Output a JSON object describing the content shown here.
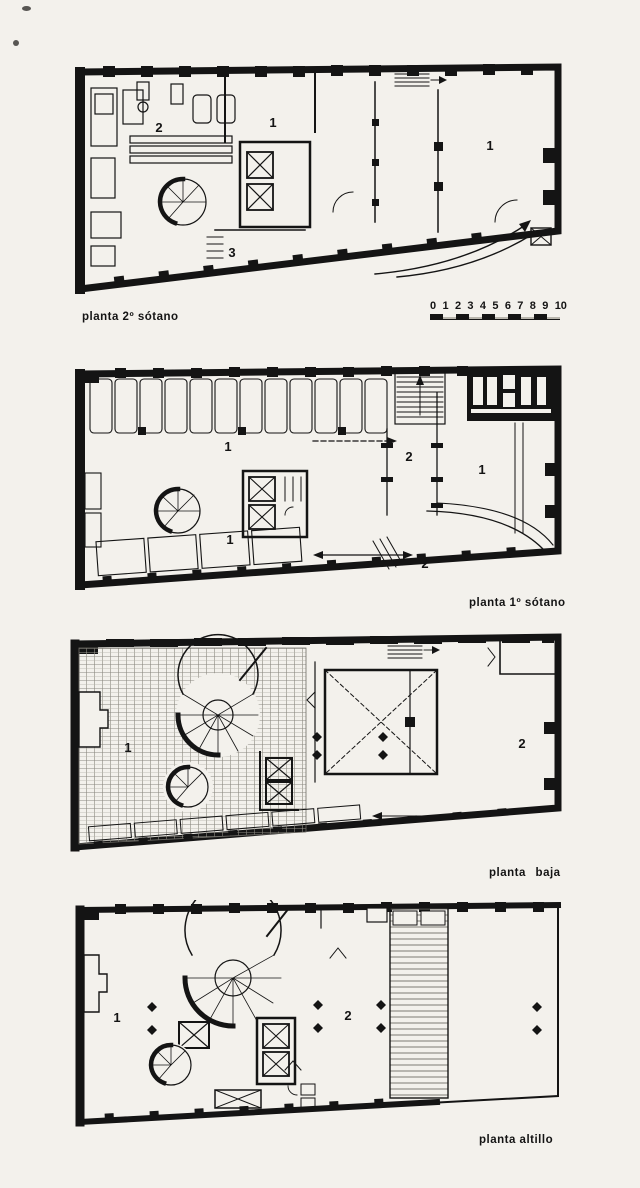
{
  "page": {
    "paper": "#f3f1ec",
    "ink": "#141414"
  },
  "scale_bar": {
    "ticks": [
      "0",
      "1",
      "2",
      "3",
      "4",
      "5",
      "6",
      "7",
      "8",
      "9",
      "10"
    ]
  },
  "plans": [
    {
      "id": "sotano2",
      "label": "planta 2º sótano",
      "rooms": [
        "2",
        "1",
        "1",
        "3"
      ]
    },
    {
      "id": "sotano1",
      "label": "planta 1º sótano",
      "rooms": [
        "1",
        "2",
        "1",
        "1",
        "2"
      ]
    },
    {
      "id": "baja",
      "label": "planta baja",
      "rooms": [
        "1",
        "2"
      ]
    },
    {
      "id": "altillo",
      "label": "planta altillo",
      "rooms": [
        "1",
        "2"
      ]
    }
  ]
}
